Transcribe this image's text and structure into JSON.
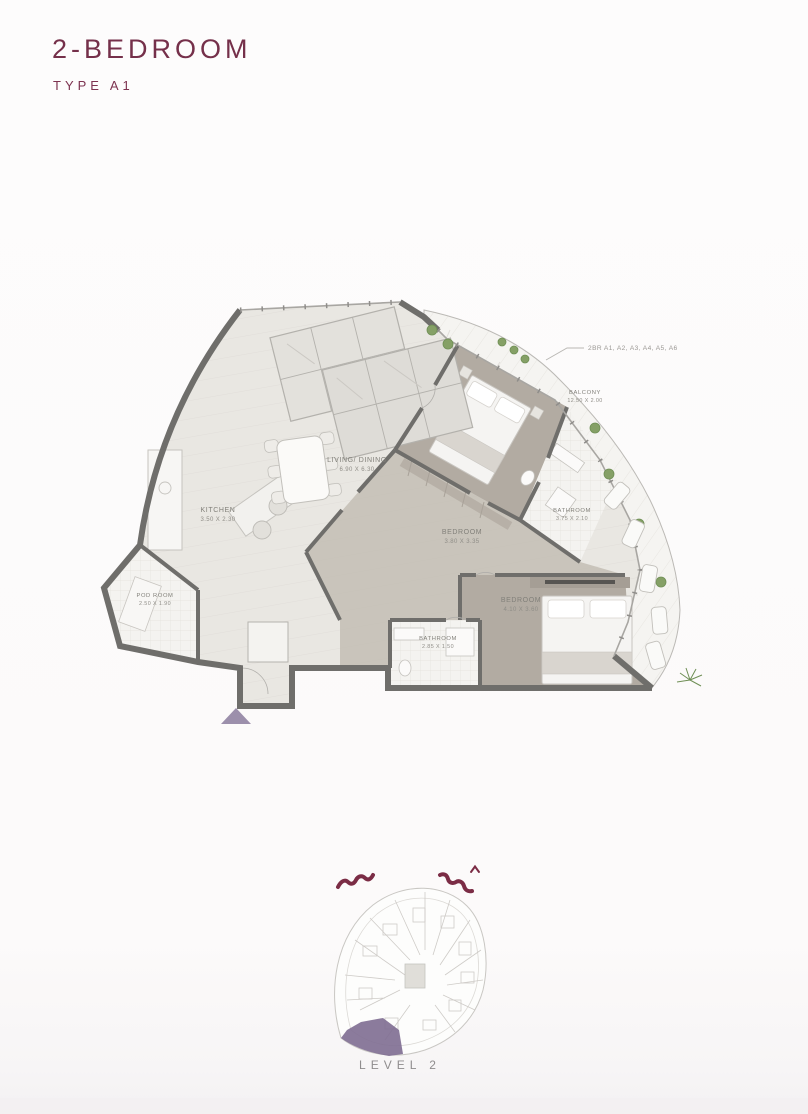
{
  "page": {
    "title": "2-BEDROOM",
    "subtitle": "TYPE A1",
    "level_label": "LEVEL 2"
  },
  "plan": {
    "unit_annotation": "2BR A1, A2, A3, A4, A5, A6",
    "rooms": [
      {
        "id": "balcony",
        "name": "BALCONY",
        "dims": "12.50 X 2.00"
      },
      {
        "id": "living",
        "name": "LIVING/ DINING",
        "dims": "6.90 X 6.30"
      },
      {
        "id": "kitchen",
        "name": "KITCHEN",
        "dims": "3.50 X 2.30"
      },
      {
        "id": "pod",
        "name": "POD ROOM",
        "dims": "2.50 X 1.90"
      },
      {
        "id": "bedroom1",
        "name": "BEDROOM",
        "dims": "3.80 X 3.35"
      },
      {
        "id": "bathroom1",
        "name": "BATHROOM",
        "dims": "3.75 X 2.10"
      },
      {
        "id": "bedroom2",
        "name": "BEDROOM",
        "dims": "4.10 X 3.60"
      },
      {
        "id": "bathroom2",
        "name": "BATHROOM",
        "dims": "2.85 X 1.50"
      }
    ]
  },
  "colors": {
    "accent": "#75304A",
    "highlight": "#7E6D91",
    "wall": "#6F6E6B",
    "floor": "#E9E7E2",
    "bedroom_floor": "#B2ABA2",
    "balcony": "#F5F4F1",
    "plant": "#85A066"
  }
}
